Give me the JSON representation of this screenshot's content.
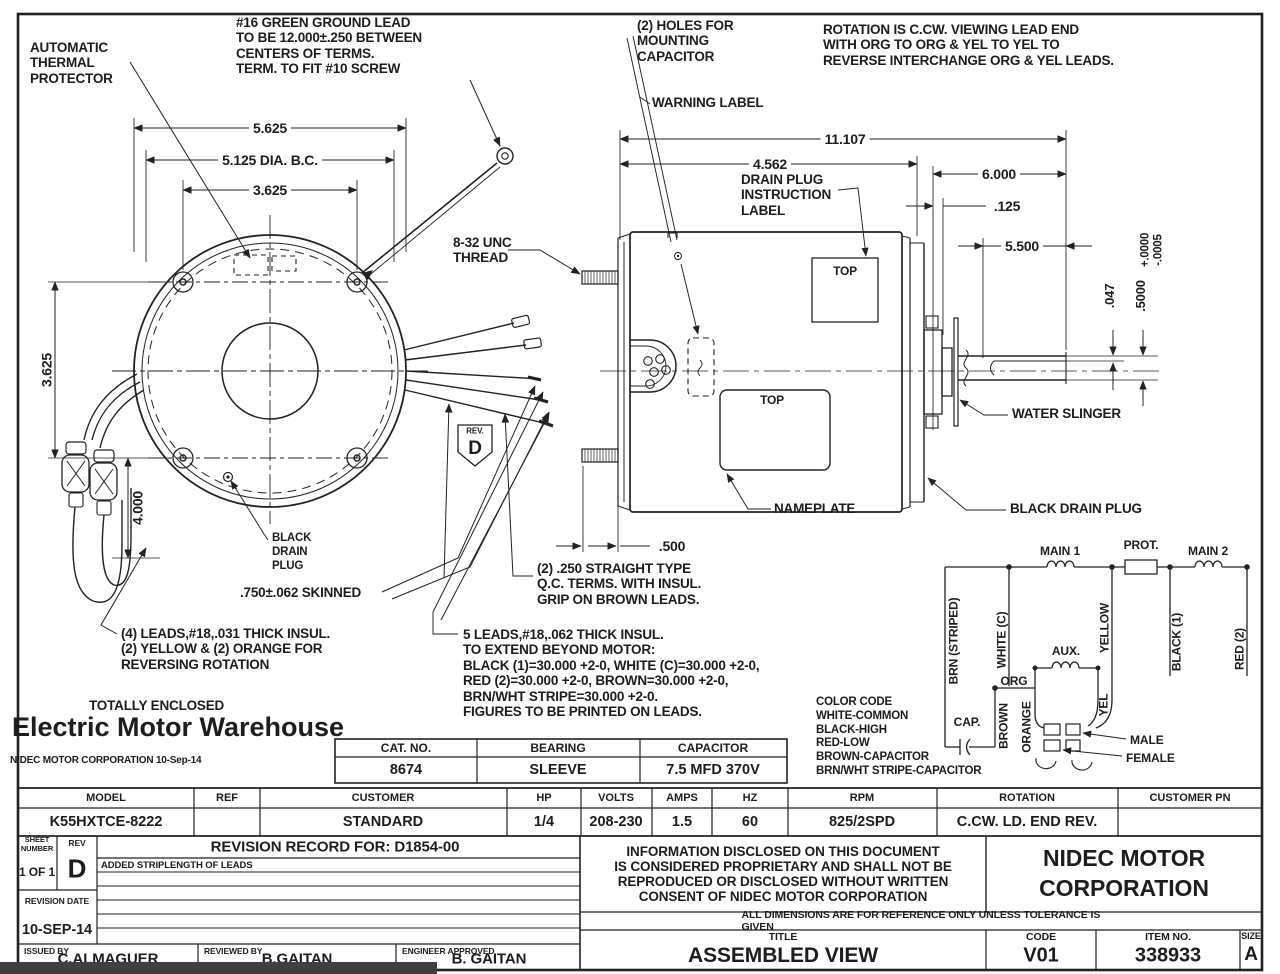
{
  "labels": {
    "auto_thermal": "AUTOMATIC\nTHERMAL\nPROTECTOR",
    "ground_lead": "#16 GREEN GROUND LEAD\nTO BE 12.000±.250 BETWEEN\nCENTERS OF TERMS.\nTERM. TO FIT #10 SCREW",
    "holes_capacitor": "(2) HOLES FOR\nMOUNTING\nCAPACITOR",
    "rotation_note": "ROTATION IS C.CW. VIEWING LEAD END\nWITH ORG TO ORG & YEL TO YEL TO\nREVERSE INTERCHANGE ORG & YEL LEADS.",
    "warning_label": "WARNING LABEL",
    "drain_plug_label": "DRAIN PLUG\nINSTRUCTION\nLABEL",
    "unc_thread": "8-32 UNC\nTHREAD",
    "water_slinger": "WATER SLINGER",
    "nameplate": "NAMEPLATE",
    "black_drain_plug": "BLACK DRAIN PLUG",
    "black_drain_plug_left": "BLACK\nDRAIN\nPLUG",
    "skinned": ".750±.062 SKINNED",
    "qc_terms": "(2) .250 STRAIGHT TYPE\nQ.C. TERMS. WITH INSUL.\nGRIP ON BROWN LEADS.",
    "leads4": "(4) LEADS,#18,.031 THICK INSUL.\n(2) YELLOW & (2) ORANGE FOR\nREVERSING ROTATION",
    "leads5": "5 LEADS,#18,.062 THICK INSUL.\nTO EXTEND BEYOND MOTOR:\nBLACK (1)=30.000 +2-0, WHITE (C)=30.000 +2-0,\nRED (2)=30.000 +2-0, BROWN=30.000 +2-0,\nBRN/WHT STRIPE=30.000 +2-0.\nFIGURES TO BE PRINTED ON LEADS.",
    "totally_enclosed": "TOTALLY ENCLOSED",
    "color_code": "COLOR CODE\nWHITE-COMMON\nBLACK-HIGH\nRED-LOW\nBROWN-CAPACITOR\nBRN/WHT STRIPE-CAPACITOR",
    "top_marker_1": "TOP",
    "top_marker_2": "TOP",
    "rev_small": "REV.",
    "rev_letter": "D"
  },
  "dims": {
    "d5625": "5.625",
    "d5125": "5.125 DIA. B.C.",
    "d3625_top": "3.625",
    "d3625_left": "3.625",
    "d4000": "4.000",
    "d11107": "11.107",
    "d4562": "4.562",
    "d6000": "6.000",
    "d125": ".125",
    "d5500": "5.500",
    "d047": ".047",
    "d5000": ".5000",
    "d5000_tol": "+.0000\n-.0005",
    "d500": ".500"
  },
  "watermark": {
    "name": "Electric Motor Warehouse",
    "corp_date": "NIDEC MOTOR CORPORATION 10-Sep-14"
  },
  "schematic": {
    "main1": "MAIN 1",
    "prot": "PROT.",
    "main2": "MAIN 2",
    "aux": "AUX.",
    "cap": "CAP.",
    "org": "ORG",
    "yel": "YEL",
    "brn_striped": "BRN (STRIPED)",
    "white_c": "WHITE (C)",
    "yellow": "YELLOW",
    "black1": "BLACK (1)",
    "red2": "RED (2)",
    "brown": "BROWN",
    "orange": "ORANGE",
    "male": "MALE",
    "female": "FEMALE"
  },
  "spec_table": {
    "headers": [
      "CAT. NO.",
      "BEARING",
      "CAPACITOR"
    ],
    "values": [
      "8674",
      "SLEEVE",
      "7.5 MFD 370V"
    ]
  },
  "model_table": {
    "headers": [
      "MODEL",
      "REF",
      "CUSTOMER",
      "HP",
      "VOLTS",
      "AMPS",
      "HZ",
      "RPM",
      "ROTATION",
      "CUSTOMER PN"
    ],
    "values": [
      "K55HXTCE-8222",
      "",
      "STANDARD",
      "1/4",
      "208-230",
      "1.5",
      "60",
      "825/2SPD",
      "C.CW. LD. END REV.",
      ""
    ]
  },
  "title_block": {
    "sheet_label": "SHEET\nNUMBER",
    "sheet_value": "1 OF 1",
    "rev_label": "REV",
    "rev_value": "D",
    "revision_record": "REVISION RECORD FOR: D1854-00",
    "revision_entry": "ADDED STRIPLENGTH OF LEADS",
    "revision_date_label": "REVISION DATE",
    "revision_date": "10-SEP-14",
    "issued_label": "ISSUED BY",
    "issued": "C.ALMAGUER",
    "reviewed_label": "REVIEWED BY",
    "reviewed": "B.GAITAN",
    "approved_label": "ENGINEER APPROVED",
    "approved": "B. GAITAN",
    "legal": "INFORMATION DISCLOSED ON THIS DOCUMENT\nIS CONSIDERED PROPRIETARY AND SHALL NOT BE\nREPRODUCED OR DISCLOSED WITHOUT WRITTEN\nCONSENT OF NIDEC MOTOR CORPORATION",
    "company": "NIDEC MOTOR\nCORPORATION",
    "tolerance_note": "ALL DIMENSIONS ARE FOR REFERENCE ONLY UNLESS TOLERANCE IS GIVEN",
    "title_label": "TITLE",
    "title": "ASSEMBLED VIEW",
    "code_label": "CODE",
    "code": "V01",
    "item_label": "ITEM NO.",
    "item": "338933",
    "size_label": "SIZE",
    "size": "A"
  },
  "colors": {
    "ink": "#1d1d1d",
    "paper": "#ffffff"
  }
}
